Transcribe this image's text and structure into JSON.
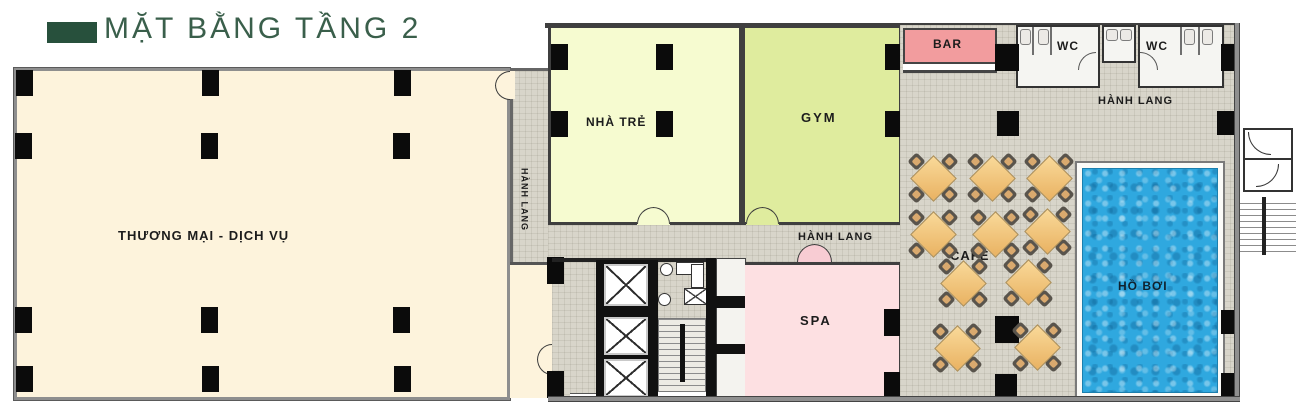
{
  "title": {
    "label": "MẶT BẰNG TẦNG 2"
  },
  "rooms": {
    "commerce": {
      "label": "THƯƠNG MẠI - DỊCH VỤ",
      "fill": "#fdf3dc"
    },
    "corridor_vertical": {
      "label": "HÀNH LANG",
      "fill": "#d8d5ca"
    },
    "corridor_middle": {
      "label": "HÀNH LANG",
      "fill": "#d8d5ca"
    },
    "corridor_top": {
      "label": "HÀNH LANG",
      "fill": "#d8d5ca"
    },
    "nursery": {
      "label": "NHÀ TRẺ",
      "fill": "#f6fbd0"
    },
    "gym": {
      "label": "GYM",
      "fill": "#dfec9e"
    },
    "bar": {
      "label": "BAR",
      "fill": "#f29c9e"
    },
    "wc_left": {
      "label": "WC",
      "fill": "#f5f5f2"
    },
    "wc_right": {
      "label": "WC",
      "fill": "#f5f5f2"
    },
    "cafe": {
      "label": "CAFE"
    },
    "spa": {
      "label": "SPA",
      "fill": "#fde0e2"
    },
    "pool": {
      "label": "HỒ BƠI",
      "fill": "#2fa8df"
    }
  },
  "palette": {
    "title_green": "#3a5f4b",
    "swatch_green": "#27503c",
    "column_black": "#0b0b0b",
    "wall_gray": "#8e8e8e",
    "wall_dark": "#3f3f3f",
    "table_wood": "#eab564",
    "pool_blue": "#2fa8df"
  },
  "furniture": {
    "cafe_table_count": 10,
    "elevator_count": 3,
    "wc_room_count": 2
  }
}
